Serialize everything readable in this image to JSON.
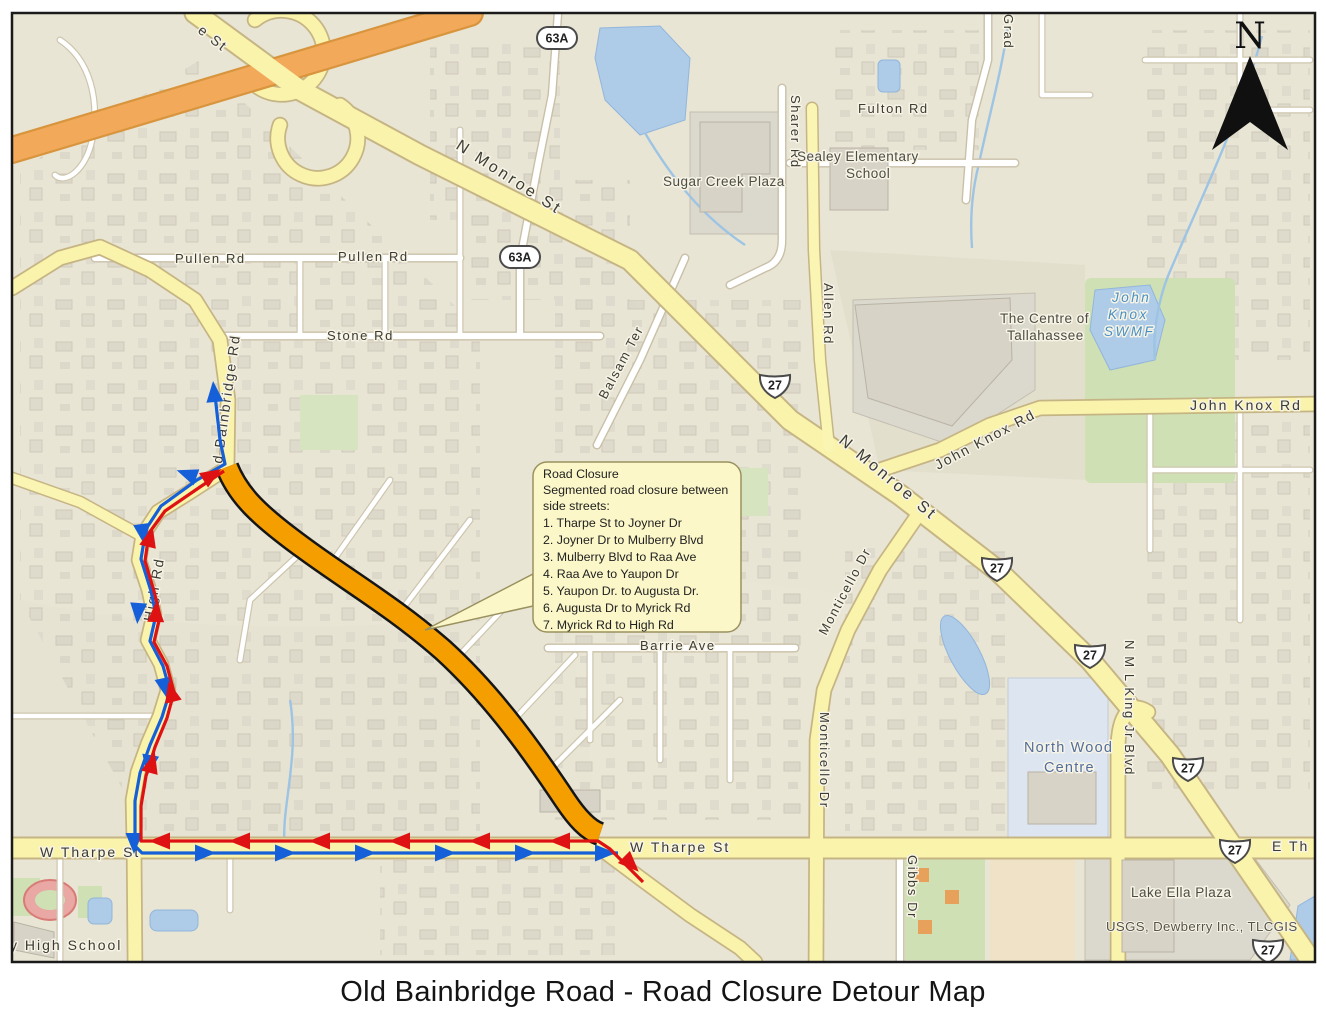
{
  "title": "Old Bainbridge Road - Road Closure Detour Map",
  "north_label": "N",
  "attribution": "USGS, Dewberry Inc., TLCGIS",
  "callout": {
    "heading": "Road Closure",
    "subheading_1": "Segmented road closure between",
    "subheading_2": "side streets:",
    "items": [
      "1. Tharpe St to Joyner Dr",
      "2. Joyner Dr to Mulberry Blvd",
      "3. Mulberry Blvd to Raa Ave",
      "4. Raa Ave to Yaupon Dr",
      "5. Yaupon Dr. to Augusta Dr.",
      "6. Augusta Dr to Myrick Rd",
      "7. Myrick Rd to High Rd"
    ]
  },
  "shields": {
    "us27": "27",
    "fl63a": "63A"
  },
  "roads": {
    "n_monroe_st": "N Monroe St",
    "monroe_top": "e St",
    "old_bainbridge_rd": "d Bainbridge Rd",
    "high_rd": "High Rd",
    "w_tharpe_st": "W Tharpe St",
    "e_tharpe_st": "E Th",
    "pullen_rd": "Pullen Rd",
    "stone_rd": "Stone Rd",
    "balsam_ter": "Balsam Ter",
    "sharer_rd": "Sharer Rd",
    "fulton_rd": "Fulton Rd",
    "allen_rd": "Allen Rd",
    "john_knox_rd": "John Knox Rd",
    "monticello_dr": "Monticello Dr",
    "barrie_ave": "Barrie Ave",
    "gibbs_dr": "Gibbs Dr",
    "mlk_blvd": "N M L King Jr Blvd",
    "grady_rd": "Grad"
  },
  "places": {
    "sugar_creek_plaza": "Sugar Creek Plaza",
    "sealey_line1": "Sealey Elementary",
    "sealey_line2": "School",
    "centre_line1": "The Centre of",
    "centre_line2": "Tallahassee",
    "swmf_line1": "John",
    "swmf_line2": "Knox",
    "swmf_line3": "SWMF",
    "north_wood_line1": "North Wood",
    "north_wood_line2": "Centre",
    "lake_ella_plaza": "Lake Ella Plaza",
    "high_school": "y High School"
  },
  "colors": {
    "closure_orange": "#F59E00",
    "detour_red": "#DE1212",
    "detour_blue": "#1560D8",
    "highway_orange": "#F2AA5A",
    "major_road_yellow": "#FAF3AB",
    "water_blue": "#AECBE8"
  }
}
